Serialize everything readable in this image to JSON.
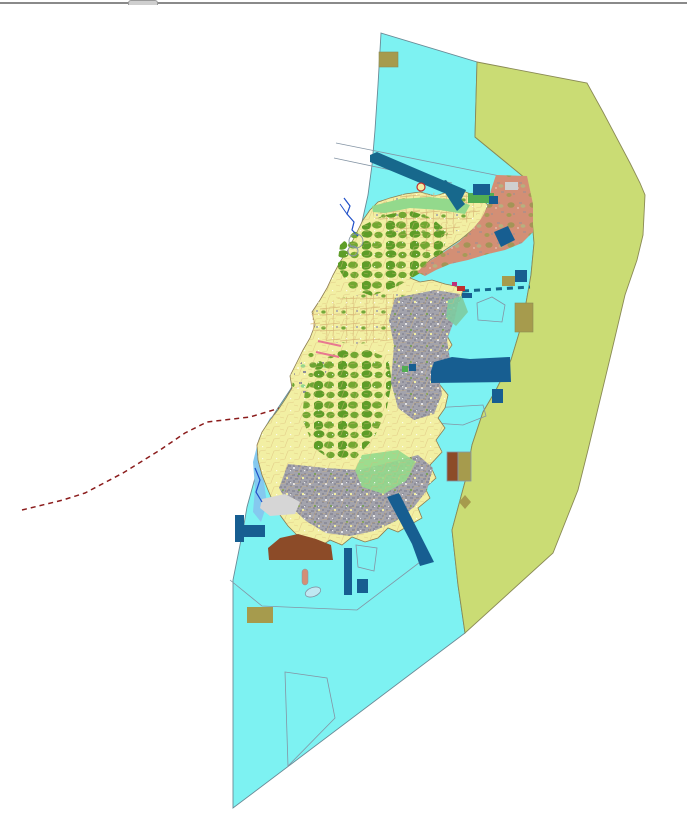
{
  "window": {
    "background": "#FFFFFF",
    "top_bar": {
      "present": true,
      "tab_present": true
    }
  },
  "palette": {
    "sea": "#7DF2F2",
    "seaStroke": "#6A8A96",
    "zone": "#CADC74",
    "zoneStroke": "#8A8A55",
    "farm": "#F2EFA3",
    "parcel": "#D9B878",
    "forest": "#5E9D28",
    "forest2": "#72A832",
    "urban": "#A3A3AC",
    "urbanDark": "#8E8E9A",
    "lightgreen": "#93D98C",
    "tealgreen": "#7ECBA0",
    "salmon": "#D38F75",
    "navy": "#175E91",
    "teal": "#17688C",
    "brown": "#8C4B28",
    "khaki": "#A69B4D",
    "lightblue": "#85C9EF",
    "grayfill": "#D6D6D6",
    "lightgray": "#CFCFCF",
    "boundary": "#8494A4",
    "redline": "#8B1C1C",
    "pink": "#E87890",
    "river": "#2050C8",
    "red": "#C03030",
    "magenta": "#C03078",
    "green2": "#52AD52",
    "islet": "#BFE8F2",
    "islandStroke": "#8A7A50",
    "barGray": "#8A8A8A",
    "tabGray": "#CFCFCF"
  },
  "map": {
    "width": 687,
    "height": 821,
    "layers": [
      {
        "name": "sea-zone",
        "kind": "poly",
        "f": "sea",
        "s": "seaStroke",
        "sw": 0.9,
        "p": "381,33 477,62 475,137 525,178 531,205 534,243 531,275 523,320 511,360 496,390 483,412 472,445 466,478 452,530 458,585 465,633 233,808 233,580 243,530 247,507 258,467 265,428 278,408 290,390 302,370 315,345 327,320 338,295 348,268 355,245 362,222 368,195 372,165 375,130 378,85"
      },
      {
        "name": "east-restricted-zone",
        "kind": "poly",
        "f": "zone",
        "s": "zoneStroke",
        "sw": 0.9,
        "p": "477,62 587,83 603,112 630,163 640,183 645,195 643,235 637,260 625,295 612,350 600,400 588,450 578,490 553,553 465,633 458,585 452,530 466,478 472,445 483,412 496,390 511,360 523,320 531,275 534,243 531,205 525,178 475,137"
      },
      {
        "name": "boundary-line-nw-1",
        "kind": "line",
        "s": "boundary",
        "sw": 0.8,
        "p": "336,143 500,176"
      },
      {
        "name": "boundary-line-nw-2",
        "kind": "line",
        "s": "boundary",
        "sw": 0.8,
        "p": "334,158 452,183"
      },
      {
        "name": "dashed-red-route",
        "kind": "line",
        "s": "redline",
        "sw": 1.5,
        "dash": "5,4",
        "p": "22,510 63,500 85,493 123,473 160,450 185,433 207,422 250,417 280,408 303,412"
      },
      {
        "name": "subzone-boundary-se",
        "kind": "line",
        "s": "boundary",
        "sw": 0.8,
        "p": "230,580 262,606 357,610 428,556"
      },
      {
        "name": "outline-polygon-bottom",
        "kind": "poly",
        "f": "none",
        "s": "boundary",
        "sw": 0.8,
        "p": "285,672 327,678 335,718 288,766"
      },
      {
        "name": "outline-polygon-south",
        "kind": "poly",
        "f": "none",
        "s": "boundary",
        "sw": 0.8,
        "p": "356,545 377,548 374,571 358,567"
      },
      {
        "name": "outline-pentagon-east",
        "kind": "poly",
        "f": "none",
        "s": "boundary",
        "sw": 0.8,
        "p": "477,303 492,297 505,305 502,322 478,320"
      },
      {
        "name": "outline-polygon-east",
        "kind": "poly",
        "f": "none",
        "s": "boundary",
        "sw": 0.8,
        "p": "432,408 483,405 486,416 463,425 434,423"
      },
      {
        "name": "west-coast-shallows",
        "kind": "poly",
        "f": "lightblue",
        "p": "270,418 277,412 271,438 266,460 264,482 267,504 261,522 253,512 255,488 253,462 259,438"
      },
      {
        "name": "island-base",
        "kind": "poly",
        "f": "farm",
        "s": "islandStroke",
        "sw": 0.8,
        "p": "370,210 378,202 390,198 405,194 420,192 435,196 448,192 458,189 468,193 480,198 488,205 482,220 472,230 460,240 445,250 430,260 420,270 410,278 420,282 432,280 445,284 455,286 463,290 460,300 452,310 448,322 445,332 452,345 445,355 435,362 432,372 440,385 448,395 445,408 438,418 445,428 436,440 442,452 430,465 436,478 425,488 430,498 418,508 422,518 408,526 398,532 388,528 378,538 365,542 352,537 342,545 330,540 318,548 306,542 296,534 288,526 280,515 274,504 268,490 262,475 258,460 257,445 262,432 270,420 278,410 286,398 292,388 290,376 297,362 303,350 310,338 315,325 312,312 320,300 327,288 333,275 340,262 348,250 353,240 358,230 363,220"
      },
      {
        "name": "farmland-north",
        "kind": "poly",
        "f": "none",
        "tex": "farm",
        "p": "372,207 400,196 430,193 458,191 477,199 486,206 470,220 448,238 428,252 408,240 388,228 374,218"
      },
      {
        "name": "forest-north",
        "kind": "poly",
        "f": "none",
        "tex": "forest",
        "p": "340,245 358,228 382,216 408,210 432,218 448,232 442,256 422,272 398,286 372,296 350,288 337,266"
      },
      {
        "name": "farmland-middle",
        "kind": "poly",
        "f": "none",
        "tex": "farm",
        "p": "312,312 338,298 368,294 398,294 422,300 430,312 418,330 392,340 358,344 328,342 310,328"
      },
      {
        "name": "mixed-west",
        "kind": "poly",
        "f": "none",
        "tex": "mixed",
        "p": "295,370 310,352 330,362 322,382 306,396 292,386"
      },
      {
        "name": "forest-central",
        "kind": "poly",
        "f": "none",
        "tex": "forest",
        "p": "305,390 318,362 342,350 368,350 388,358 392,382 386,412 374,438 356,458 334,462 314,448 302,418"
      },
      {
        "name": "urban-east",
        "kind": "poly",
        "f": "urban",
        "tex": "urban",
        "p": "395,298 435,290 460,294 455,318 447,340 450,360 438,374 442,394 434,414 414,420 398,408 391,382 394,345 389,320"
      },
      {
        "name": "urban-south",
        "kind": "poly",
        "f": "urban",
        "tex": "urban",
        "p": "288,464 325,468 358,470 392,462 418,455 433,468 427,490 414,507 396,521 374,531 350,536 326,533 306,521 289,505 279,488"
      },
      {
        "name": "greenbelt-south",
        "kind": "poly",
        "f": "lightgreen",
        "op": 0.9,
        "p": "362,455 398,450 416,462 406,481 384,494 362,487 355,470"
      },
      {
        "name": "greenbelt-east",
        "kind": "poly",
        "f": "tealgreen",
        "op": 0.9,
        "p": "448,300 462,296 468,312 456,326 446,318"
      },
      {
        "name": "island-parcel-texture",
        "kind": "poly",
        "f": "none",
        "tex": "noise",
        "p": "370,210 378,202 390,198 405,194 420,192 435,196 448,192 458,189 468,193 480,198 488,205 482,220 472,230 460,240 445,250 430,260 420,270 410,278 420,282 432,280 445,284 455,286 463,290 460,300 452,310 448,322 445,332 452,345 445,355 435,362 432,372 440,385 448,395 445,408 438,418 445,428 436,440 442,452 430,465 436,478 425,488 430,498 418,508 422,518 408,526 398,532 388,528 378,538 365,542 352,537 342,545 330,540 318,548 306,542 296,534 288,526 280,515 274,504 268,490 262,475 258,460 257,445 262,432 270,420 278,410 286,398 292,388 290,376 297,362 303,350 310,338 315,325 312,312 320,300 327,288 333,275 340,262 348,250 353,240 358,230 363,220"
      },
      {
        "name": "salmon-district-ne",
        "kind": "poly",
        "f": "salmon",
        "tex": "mixed",
        "texop": 0.45,
        "p": "496,175 527,176 533,204 533,232 522,243 505,250 488,254 468,260 450,264 436,270 425,276 417,272 428,262 444,252 459,242 471,231 481,219 488,206 491,190"
      },
      {
        "name": "coastal-strip-north",
        "kind": "poly",
        "f": "lightgreen",
        "p": "372,206 400,199 430,197 455,200 470,205 465,214 440,210 410,208 385,213 373,212"
      },
      {
        "name": "green-block-ne",
        "kind": "rect",
        "x": 468,
        "y": 193,
        "w": 26,
        "h": 10,
        "f": "green2"
      },
      {
        "name": "gray-flat-west",
        "kind": "poly",
        "f": "grayfill",
        "p": "262,499 285,494 300,502 295,514 270,516 260,508"
      },
      {
        "name": "lightgray-block-ne",
        "kind": "rect",
        "x": 505,
        "y": 182,
        "w": 13,
        "h": 8,
        "f": "lightgray"
      },
      {
        "name": "channel-band-nw",
        "kind": "poly",
        "f": "teal",
        "p": "370,155 377,152 466,190 461,200 370,162"
      },
      {
        "name": "channel-band-nw-2",
        "kind": "poly",
        "f": "teal",
        "p": "438,182 446,180 465,204 457,211"
      },
      {
        "name": "navy-rect-ne",
        "kind": "rect",
        "x": 473,
        "y": 184,
        "w": 17,
        "h": 11,
        "f": "navy"
      },
      {
        "name": "navy-square-ne",
        "kind": "rect",
        "x": 489,
        "y": 196,
        "w": 9,
        "h": 8,
        "f": "navy"
      },
      {
        "name": "navy-square-east",
        "kind": "rect",
        "x": 515,
        "y": 270,
        "w": 12,
        "h": 12,
        "f": "navy"
      },
      {
        "name": "navy-band-ne",
        "kind": "poly",
        "f": "navy",
        "p": "494,232 508,226 515,240 501,247"
      },
      {
        "name": "port-basin-east",
        "kind": "poly",
        "f": "navy",
        "p": "434,362 452,357 470,359 510,357 511,382 431,383 431,371"
      },
      {
        "name": "navy-square-east-2",
        "kind": "rect",
        "x": 492,
        "y": 389,
        "w": 11,
        "h": 14,
        "f": "navy"
      },
      {
        "name": "breakwater-band-se",
        "kind": "poly",
        "f": "navy",
        "p": "387,497 399,493 431,556 434,562 420,566 412,544"
      },
      {
        "name": "navy-strip-south",
        "kind": "rect",
        "x": 344,
        "y": 548,
        "w": 8,
        "h": 47,
        "f": "navy"
      },
      {
        "name": "navy-square-south",
        "kind": "rect",
        "x": 357,
        "y": 579,
        "w": 11,
        "h": 14,
        "f": "navy"
      },
      {
        "name": "navy-lshape-west",
        "kind": "poly",
        "f": "navy",
        "p": "235,515 244,515 244,525 265,525 265,537 244,537 244,542 235,542"
      },
      {
        "name": "navy-dot-center",
        "kind": "rect",
        "x": 409,
        "y": 364,
        "w": 7,
        "h": 7,
        "f": "navy"
      },
      {
        "name": "green-dot-center",
        "kind": "rect",
        "x": 402,
        "y": 366,
        "w": 6,
        "h": 6,
        "f": "green2"
      },
      {
        "name": "khaki-block-top",
        "kind": "rect",
        "x": 379,
        "y": 52,
        "w": 19,
        "h": 15,
        "f": "khaki",
        "s": "zoneStroke",
        "sw": 0.6
      },
      {
        "name": "khaki-block-east",
        "kind": "rect",
        "x": 502,
        "y": 276,
        "w": 13,
        "h": 10,
        "f": "khaki"
      },
      {
        "name": "khaki-block-east-2",
        "kind": "rect",
        "x": 515,
        "y": 303,
        "w": 18,
        "h": 29,
        "f": "khaki",
        "s": "zoneStroke",
        "sw": 0.6
      },
      {
        "name": "khaki-block-southwest",
        "kind": "rect",
        "x": 247,
        "y": 607,
        "w": 26,
        "h": 16,
        "f": "khaki"
      },
      {
        "name": "khaki-diamond-south",
        "kind": "poly",
        "f": "khaki",
        "p": "465,495 471,502 465,509 459,502"
      },
      {
        "name": "reclaimed-land-brown",
        "kind": "poly",
        "f": "brown",
        "p": "268,548 280,538 298,534 316,539 331,545 333,560 269,560"
      },
      {
        "name": "facility-brown-half",
        "kind": "rect",
        "x": 447,
        "y": 452,
        "w": 11,
        "h": 29,
        "f": "brown",
        "s": "boundary",
        "sw": 0.8
      },
      {
        "name": "facility-khaki-half",
        "kind": "rect",
        "x": 458,
        "y": 452,
        "w": 13,
        "h": 29,
        "f": "khaki",
        "s": "boundary",
        "sw": 0.8
      },
      {
        "name": "river-north",
        "kind": "line",
        "s": "river",
        "sw": 1.2,
        "p": "344,198 350,206 347,214 354,222 352,230 358,236"
      },
      {
        "name": "river-north-branch",
        "kind": "line",
        "s": "river",
        "sw": 1,
        "p": "340,204 347,214"
      },
      {
        "name": "river-west",
        "kind": "line",
        "s": "river",
        "sw": 1.2,
        "p": "255,468 260,480 256,492 262,502"
      },
      {
        "name": "pink-line-1",
        "kind": "line",
        "s": "pink",
        "sw": 2,
        "p": "318,341 341,346"
      },
      {
        "name": "pink-line-2",
        "kind": "line",
        "s": "pink",
        "sw": 2,
        "p": "316,352 339,357"
      },
      {
        "name": "dashed-jetty-east",
        "kind": "line",
        "s": "teal",
        "sw": 3,
        "dash": "6,5",
        "p": "463,291 530,287"
      },
      {
        "name": "harbor-magenta-mark",
        "kind": "rect",
        "x": 452,
        "y": 282,
        "w": 5,
        "h": 4,
        "f": "magenta"
      },
      {
        "name": "harbor-red-mark",
        "kind": "rect",
        "x": 457,
        "y": 286,
        "w": 8,
        "h": 5,
        "f": "red"
      },
      {
        "name": "harbor-navy-mark",
        "kind": "rect",
        "x": 462,
        "y": 293,
        "w": 10,
        "h": 5,
        "f": "navy"
      },
      {
        "name": "marker-circle-red",
        "kind": "circle",
        "cx": 421,
        "cy": 187,
        "r": 4,
        "f": "farm",
        "s": "red",
        "sw": 1.2
      },
      {
        "name": "marker-circle-1",
        "kind": "circle",
        "cx": 356,
        "cy": 241,
        "r": 7,
        "f": "none",
        "s": "boundary",
        "sw": 0.9
      },
      {
        "name": "marker-circle-2",
        "kind": "circle",
        "cx": 353,
        "cy": 251,
        "r": 5,
        "f": "none",
        "s": "boundary",
        "sw": 0.9
      },
      {
        "name": "islet-ellipse-south",
        "kind": "ellipse",
        "cx": 313,
        "cy": 592,
        "rx": 8,
        "ry": 4.5,
        "rot": -20,
        "f": "islet",
        "s": "boundary",
        "sw": 0.8
      },
      {
        "name": "salmon-figure-south",
        "kind": "rect",
        "x": 302,
        "y": 569,
        "w": 6,
        "h": 16,
        "rx": 3,
        "f": "salmon",
        "s": "boundary",
        "sw": 0.5
      }
    ]
  }
}
